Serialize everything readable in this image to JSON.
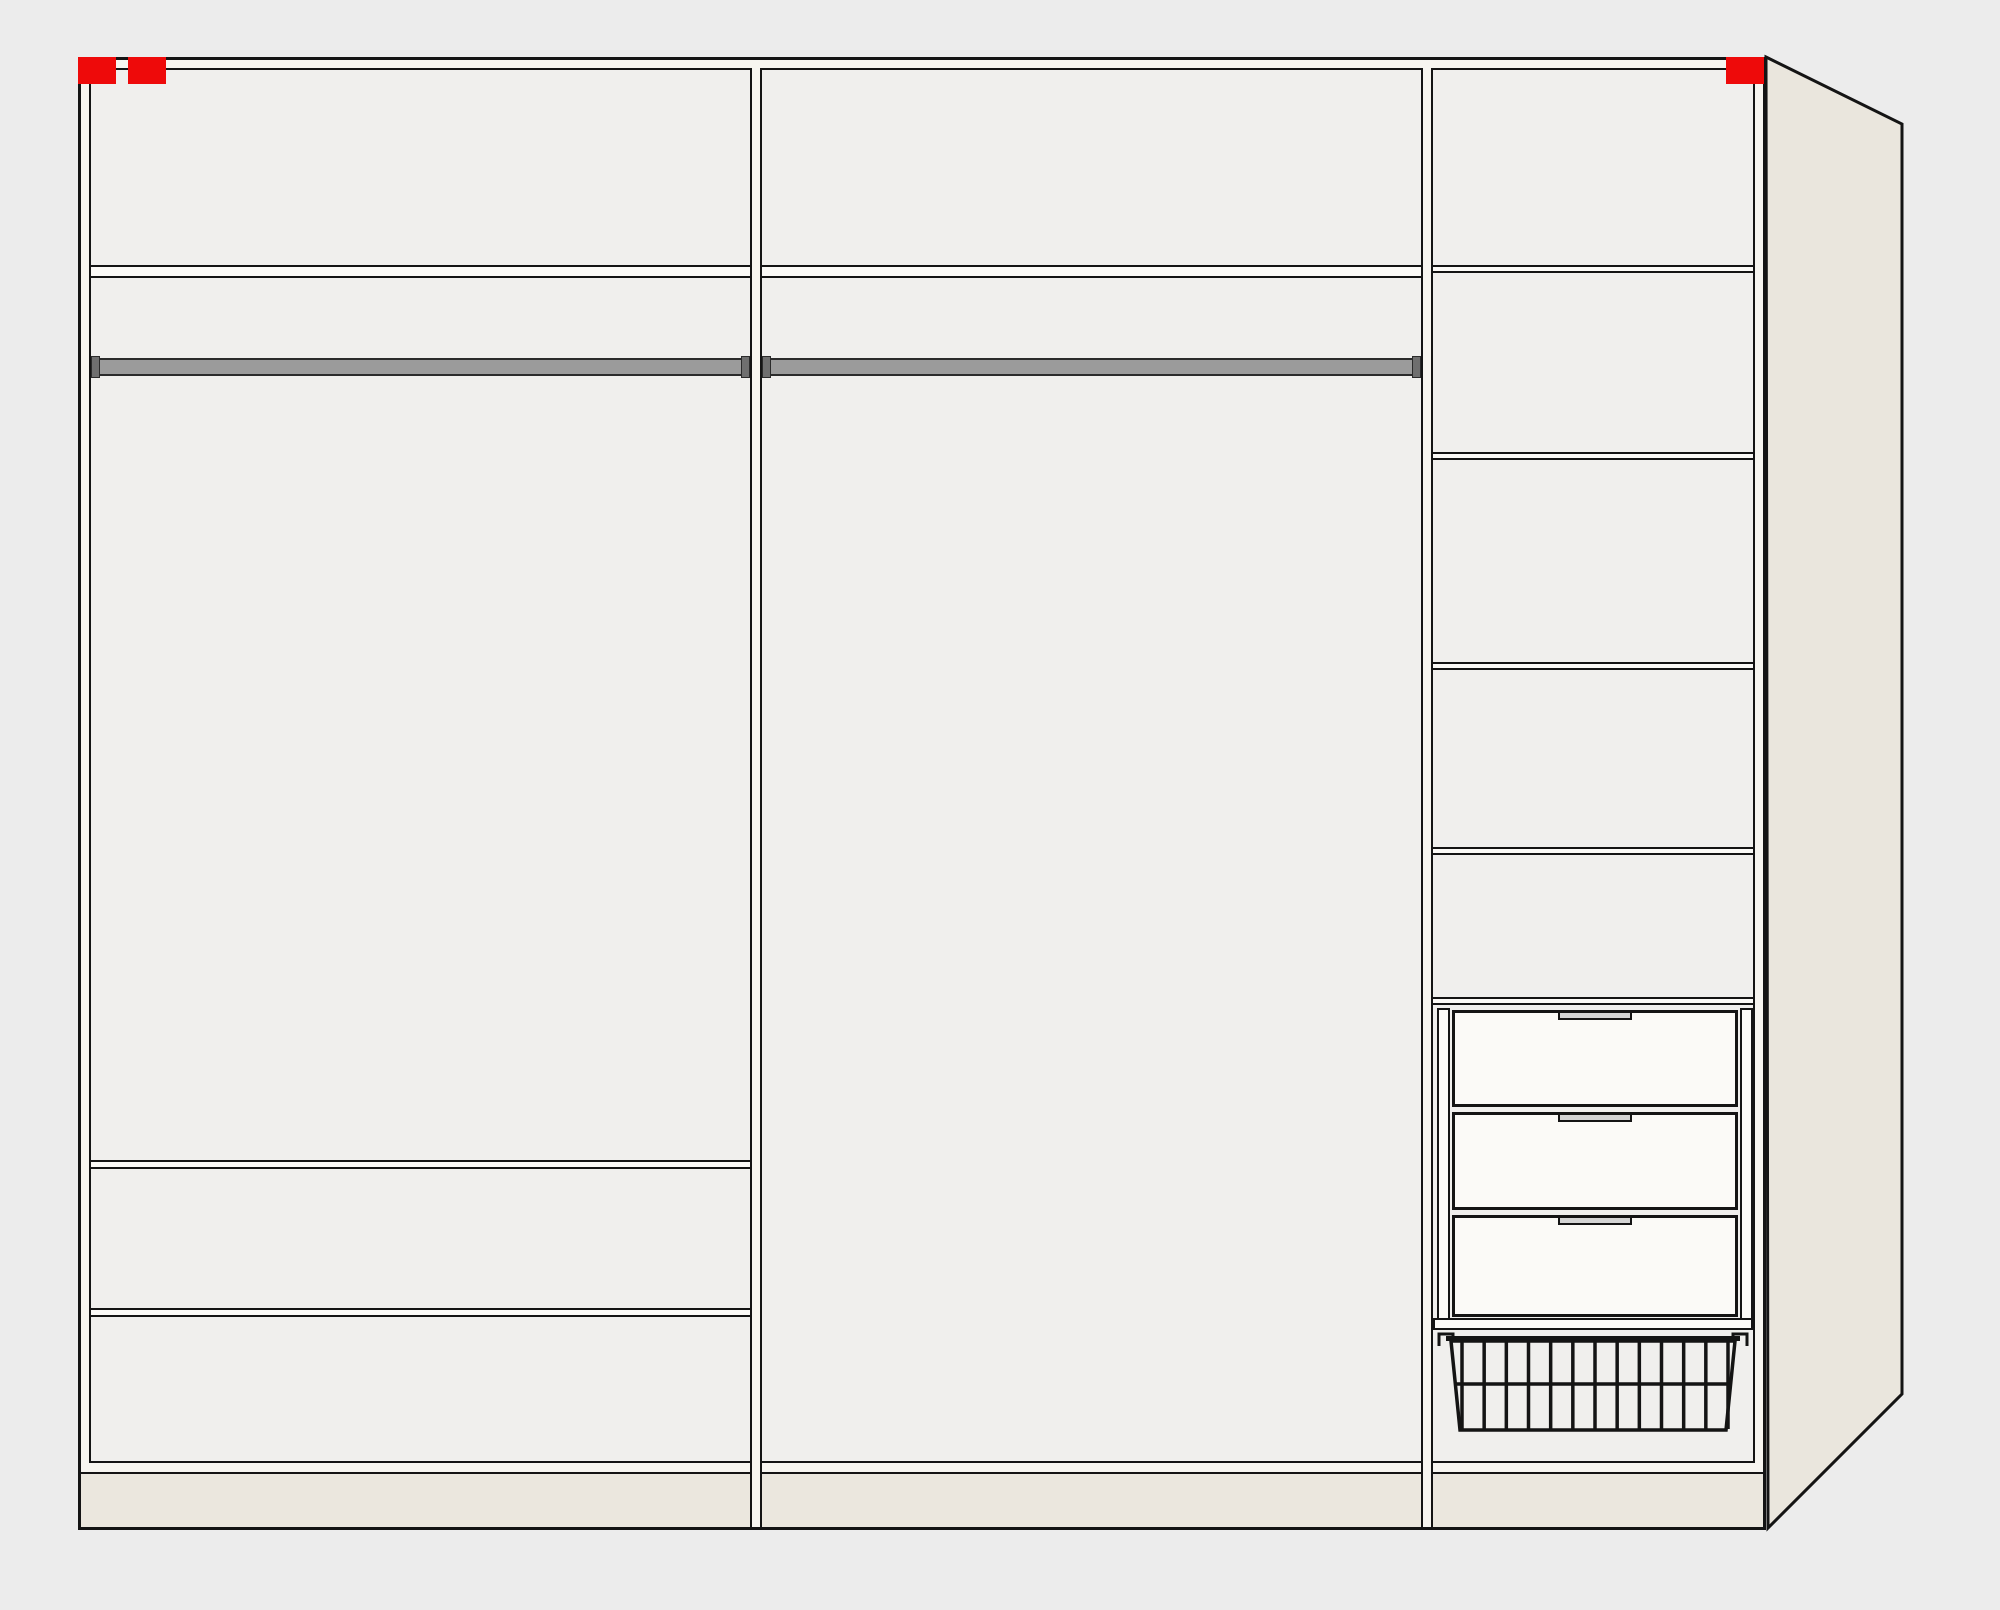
{
  "meta": {
    "description": "Wardrobe interior configuration diagram, front elevation with perspective side panel",
    "view": "front-elevation"
  },
  "colors": {
    "bg": "#ececec",
    "wall": "#f7f5f0",
    "interior": "#f0efed",
    "shelf": "#fbfaf7",
    "line": "#141414",
    "beige": "#eae6dd",
    "plinth": "#ebe7de",
    "rail": "#9b9b9b",
    "railCap": "#6f6f6f",
    "railBorder": "#2b2b2b",
    "handle": "#d4d4d4",
    "marker": "#ee0a0a"
  },
  "stage": {
    "w": 2000,
    "h": 1610
  },
  "side_panel": {
    "points": "1766,57 1902,124 1902,1394 1768,1528",
    "fill": "$beige",
    "stroke": "$line",
    "stroke_width": 3
  },
  "basket": {
    "x": 1433,
    "y": 1326,
    "w": 320,
    "h": 114,
    "bars": 13,
    "bar_x_start": 29,
    "bar_x_end": 295,
    "bar_y_top": 15,
    "bar_y_bottom": 103,
    "outline": "18,15 302,15 293,104 27,104",
    "top_bar": {
      "x": 13,
      "y": 10,
      "w": 294,
      "h": 5
    },
    "mid_bar_y": 58,
    "hook_left": "M6,20 V8 H20 V14",
    "hook_right": "M314,20 V8 H300 V14"
  },
  "elements": [
    {
      "type": "side-panel",
      "name": "side-panel",
      "interactable": false
    },
    {
      "name": "wardrobe-frame",
      "interactable": false,
      "css": {
        "left": "78px",
        "top": "57px",
        "width": "1688px",
        "height": "1473px",
        "background": "$wall",
        "border": "3px solid $line"
      }
    },
    {
      "name": "section-left-interior",
      "interactable": true,
      "css": {
        "left": "89px",
        "top": "68px",
        "width": "663px",
        "height": "1395px",
        "background": "$interior",
        "border": "2px solid $line"
      }
    },
    {
      "name": "section-middle-interior",
      "interactable": true,
      "css": {
        "left": "760px",
        "top": "68px",
        "width": "663px",
        "height": "1395px",
        "background": "$interior",
        "border": "2px solid $line"
      }
    },
    {
      "name": "section-right-interior",
      "interactable": true,
      "css": {
        "left": "1431px",
        "top": "68px",
        "width": "324px",
        "height": "1395px",
        "background": "$interior",
        "border": "2px solid $line"
      }
    },
    {
      "name": "bottom-panel-line",
      "interactable": false,
      "css": {
        "left": "81px",
        "top": "1472px",
        "width": "1682px",
        "height": "2px",
        "background": "$line"
      }
    },
    {
      "name": "plinth",
      "interactable": false,
      "css": {
        "left": "81px",
        "top": "1474px",
        "width": "1682px",
        "height": "53px",
        "background": "$plinth"
      }
    },
    {
      "name": "divider-left-middle",
      "interactable": false,
      "css": {
        "left": "750px",
        "top": "1461px",
        "width": "12px",
        "height": "66px",
        "background": "$wall",
        "border-left": "2px solid $line",
        "border-right": "2px solid $line"
      }
    },
    {
      "name": "divider-middle-right",
      "interactable": false,
      "css": {
        "left": "1421px",
        "top": "1461px",
        "width": "12px",
        "height": "66px",
        "background": "$wall",
        "border-left": "2px solid $line",
        "border-right": "2px solid $line"
      }
    },
    {
      "name": "top-shelf-left",
      "interactable": true,
      "css": {
        "left": "91px",
        "top": "265px",
        "width": "659px",
        "height": "13px",
        "background": "$shelf",
        "border-top": "2px solid $line",
        "border-bottom": "2px solid $line"
      }
    },
    {
      "name": "top-shelf-middle",
      "interactable": true,
      "css": {
        "left": "762px",
        "top": "265px",
        "width": "659px",
        "height": "13px",
        "background": "$shelf",
        "border-top": "2px solid $line",
        "border-bottom": "2px solid $line"
      }
    },
    {
      "name": "hanging-rail-left",
      "interactable": true,
      "css": {
        "left": "91px",
        "top": "358px",
        "width": "659px",
        "height": "18px",
        "background": "$rail",
        "border": "2px solid $railBorder"
      }
    },
    {
      "name": "rail-endcap",
      "interactable": false,
      "css": {
        "left": "91px",
        "top": "356px",
        "width": "9px",
        "height": "22px",
        "background": "$railCap",
        "border": "1px solid $railBorder"
      }
    },
    {
      "name": "rail-endcap",
      "interactable": false,
      "css": {
        "left": "741px",
        "top": "356px",
        "width": "9px",
        "height": "22px",
        "background": "$railCap",
        "border": "1px solid $railBorder"
      }
    },
    {
      "name": "hanging-rail-middle",
      "interactable": true,
      "css": {
        "left": "762px",
        "top": "358px",
        "width": "659px",
        "height": "18px",
        "background": "$rail",
        "border": "2px solid $railBorder"
      }
    },
    {
      "name": "rail-endcap",
      "interactable": false,
      "css": {
        "left": "762px",
        "top": "356px",
        "width": "9px",
        "height": "22px",
        "background": "$railCap",
        "border": "1px solid $railBorder"
      }
    },
    {
      "name": "rail-endcap",
      "interactable": false,
      "css": {
        "left": "1412px",
        "top": "356px",
        "width": "9px",
        "height": "22px",
        "background": "$railCap",
        "border": "1px solid $railBorder"
      }
    },
    {
      "name": "shelf-left-lower-1",
      "interactable": true,
      "css": {
        "left": "91px",
        "top": "1160px",
        "width": "659px",
        "height": "9px",
        "background": "$shelf",
        "border-top": "2px solid $line",
        "border-bottom": "2px solid $line"
      }
    },
    {
      "name": "shelf-left-lower-2",
      "interactable": true,
      "css": {
        "left": "91px",
        "top": "1308px",
        "width": "659px",
        "height": "9px",
        "background": "$shelf",
        "border-top": "2px solid $line",
        "border-bottom": "2px solid $line"
      }
    },
    {
      "name": "shelf-right-1",
      "interactable": true,
      "css": {
        "left": "1433px",
        "top": "265px",
        "width": "320px",
        "height": "8px",
        "background": "$shelf",
        "border-top": "2px solid $line",
        "border-bottom": "2px solid $line"
      }
    },
    {
      "name": "shelf-right-2",
      "interactable": true,
      "css": {
        "left": "1433px",
        "top": "452px",
        "width": "320px",
        "height": "8px",
        "background": "$shelf",
        "border-top": "2px solid $line",
        "border-bottom": "2px solid $line"
      }
    },
    {
      "name": "shelf-right-3",
      "interactable": true,
      "css": {
        "left": "1433px",
        "top": "662px",
        "width": "320px",
        "height": "8px",
        "background": "$shelf",
        "border-top": "2px solid $line",
        "border-bottom": "2px solid $line"
      }
    },
    {
      "name": "shelf-right-4",
      "interactable": true,
      "css": {
        "left": "1433px",
        "top": "847px",
        "width": "320px",
        "height": "8px",
        "background": "$shelf",
        "border-top": "2px solid $line",
        "border-bottom": "2px solid $line"
      }
    },
    {
      "name": "shelf-right-5",
      "interactable": true,
      "css": {
        "left": "1433px",
        "top": "997px",
        "width": "320px",
        "height": "8px",
        "background": "$shelf",
        "border-top": "2px solid $line",
        "border-bottom": "2px solid $line"
      }
    },
    {
      "name": "drawer-runner-left",
      "interactable": false,
      "css": {
        "left": "1437px",
        "top": "1008px",
        "width": "13px",
        "height": "322px",
        "background": "$shelf",
        "border": "2px solid $line"
      }
    },
    {
      "name": "drawer-runner-right",
      "interactable": false,
      "css": {
        "left": "1740px",
        "top": "1008px",
        "width": "13px",
        "height": "322px",
        "background": "$shelf",
        "border": "2px solid $line"
      }
    },
    {
      "name": "drawer-1",
      "interactable": true,
      "css": {
        "left": "1452px",
        "top": "1010px",
        "width": "286px",
        "height": "97px",
        "background": "$shelf",
        "border": "3px solid $line"
      },
      "children": [
        {
          "name": "drawer-handle",
          "interactable": true,
          "css": {
            "left": "50%",
            "top": "-2px",
            "transform": "translateX(-50%)",
            "width": "74px",
            "height": "9px",
            "background": "$handle",
            "border": "2px solid $line"
          }
        }
      ]
    },
    {
      "name": "drawer-2",
      "interactable": true,
      "css": {
        "left": "1452px",
        "top": "1112px",
        "width": "286px",
        "height": "98px",
        "background": "$shelf",
        "border": "3px solid $line"
      },
      "children": [
        {
          "name": "drawer-handle",
          "interactable": true,
          "css": {
            "left": "50%",
            "top": "-2px",
            "transform": "translateX(-50%)",
            "width": "74px",
            "height": "9px",
            "background": "$handle",
            "border": "2px solid $line"
          }
        }
      ]
    },
    {
      "name": "drawer-3",
      "interactable": true,
      "css": {
        "left": "1452px",
        "top": "1215px",
        "width": "286px",
        "height": "102px",
        "background": "$shelf",
        "border": "3px solid $line"
      },
      "children": [
        {
          "name": "drawer-handle",
          "interactable": true,
          "css": {
            "left": "50%",
            "top": "-2px",
            "transform": "translateX(-50%)",
            "width": "74px",
            "height": "9px",
            "background": "$handle",
            "border": "2px solid $line"
          }
        }
      ]
    },
    {
      "name": "drawer-unit-base",
      "interactable": false,
      "css": {
        "left": "1433px",
        "top": "1318px",
        "width": "320px",
        "height": "12px",
        "background": "$shelf",
        "border": "2px solid $line"
      }
    },
    {
      "type": "basket",
      "name": "wire-basket",
      "interactable": true
    },
    {
      "name": "marker-top-left-1",
      "interactable": true,
      "css": {
        "left": "78px",
        "top": "57px",
        "width": "38px",
        "height": "27px",
        "background": "$marker"
      }
    },
    {
      "name": "marker-top-left-2",
      "interactable": true,
      "css": {
        "left": "128px",
        "top": "57px",
        "width": "38px",
        "height": "27px",
        "background": "$marker"
      }
    },
    {
      "name": "marker-top-right",
      "interactable": true,
      "css": {
        "left": "1726px",
        "top": "57px",
        "width": "38px",
        "height": "27px",
        "background": "$marker"
      }
    }
  ]
}
